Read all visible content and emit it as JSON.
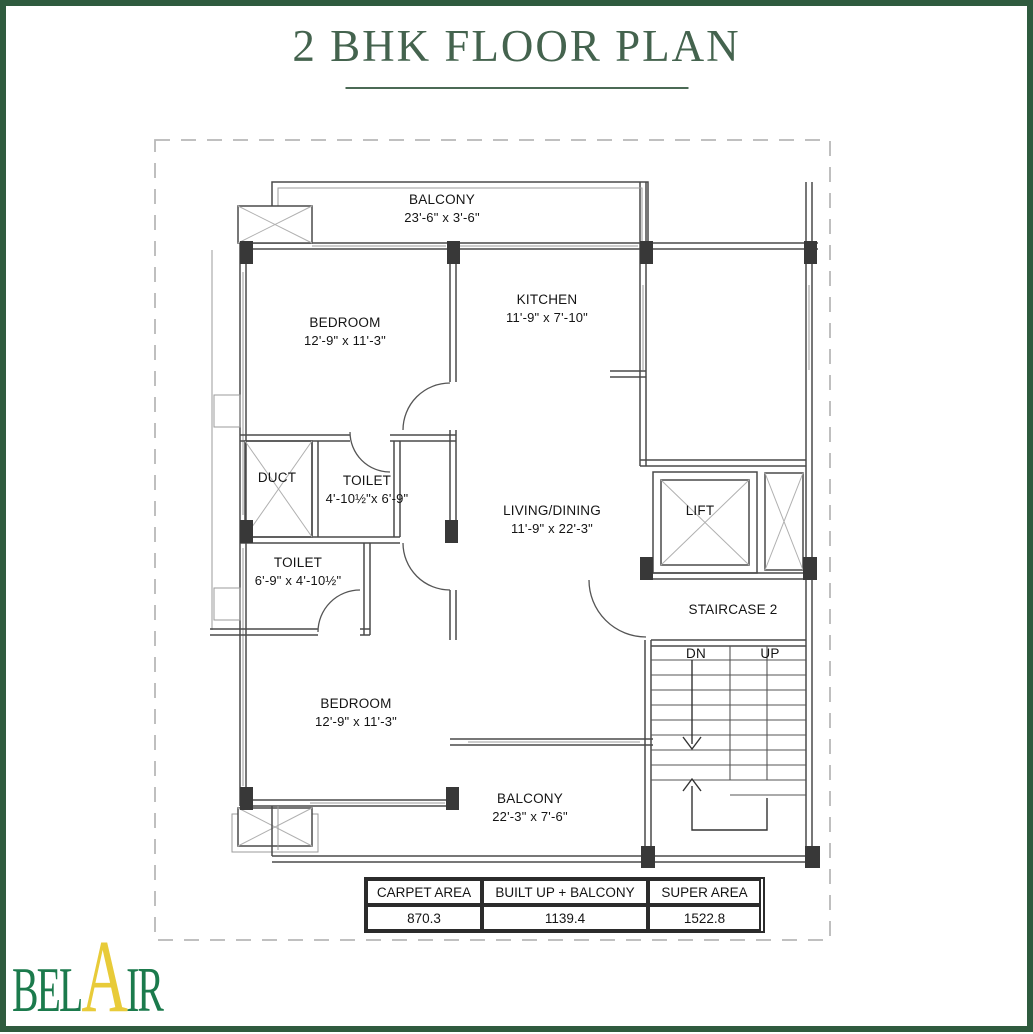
{
  "page": {
    "title": "2 BHK FLOOR PLAN"
  },
  "colors": {
    "page_border_green": "#2f5b3e",
    "title_green": "#44634e",
    "logo_green": "#1b7a4c",
    "logo_yellow": "#e8cb39"
  },
  "plan": {
    "rooms": [
      {
        "id": "balcony-top",
        "name": "BALCONY",
        "dims": "23'-6\" x 3'-6\""
      },
      {
        "id": "bedroom-upper",
        "name": "BEDROOM",
        "dims": "12'-9\" x 11'-3\""
      },
      {
        "id": "kitchen",
        "name": "KITCHEN",
        "dims": "11'-9\" x 7'-10\""
      },
      {
        "id": "toilet-upper",
        "name": "TOILET",
        "dims": "4'-10½\"x 6'-9\""
      },
      {
        "id": "toilet-lower",
        "name": "TOILET",
        "dims": "6'-9\" x 4'-10½\""
      },
      {
        "id": "living-dining",
        "name": "LIVING/DINING",
        "dims": "11'-9\" x 22'-3\""
      },
      {
        "id": "bedroom-lower",
        "name": "BEDROOM",
        "dims": "12'-9\" x 11'-3\""
      },
      {
        "id": "balcony-bottom",
        "name": "BALCONY",
        "dims": "22'-3\" x 7'-6\""
      }
    ],
    "labels": {
      "duct": "DUCT",
      "lift": "LIFT",
      "staircase": "STAIRCASE 2",
      "down": "DN",
      "up": "UP"
    }
  },
  "area_table": {
    "headers": [
      "CARPET AREA",
      "BUILT UP + BALCONY",
      "SUPER AREA"
    ],
    "values": [
      "870.3",
      "1139.4",
      "1522.8"
    ]
  },
  "logo": {
    "part1": "BEL",
    "part2": "A",
    "part3": "IR"
  }
}
